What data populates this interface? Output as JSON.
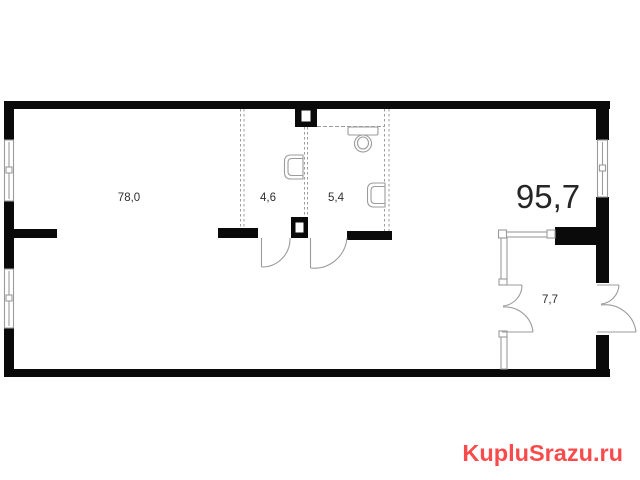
{
  "floorplan": {
    "total_area_label": "95,7",
    "rooms": [
      {
        "label": "78,0"
      },
      {
        "label": "4,6"
      },
      {
        "label": "5,4"
      },
      {
        "label": "7,7"
      }
    ]
  },
  "watermark": {
    "text": "KupluSrazu.ru",
    "color": "#f94b4b"
  },
  "colors": {
    "wall": "#0a0a0a",
    "thin_line": "#9b9b9b",
    "label_text": "#2e2e2e"
  }
}
